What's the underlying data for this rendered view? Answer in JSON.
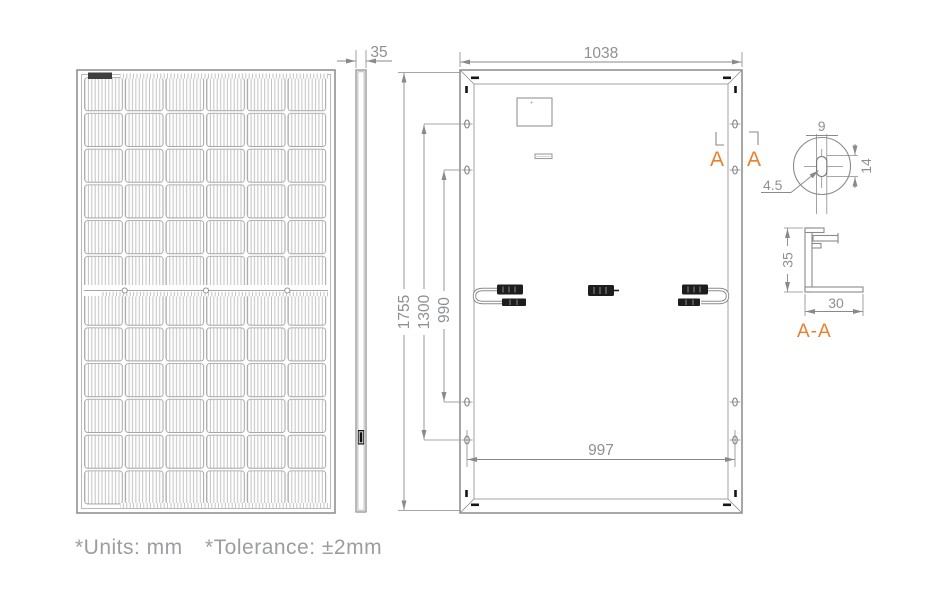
{
  "colors": {
    "line": "#8a8a8a",
    "dark": "#1d1d1d",
    "dim_text": "#8d9194",
    "accent": "#E9802C",
    "note_text": "#9a9ea1"
  },
  "dims": {
    "side_thickness": "35",
    "back_width": "1038",
    "total_height": "1755",
    "mount_span_outer": "1300",
    "mount_span_inner": "990",
    "mount_span_width": "997"
  },
  "hole_detail": {
    "slot_width": "9",
    "slot_radius": "4.5",
    "slot_height": "14"
  },
  "frame_section": {
    "height": "35",
    "depth": "30"
  },
  "section": {
    "marker_left": "A",
    "marker_right": "A",
    "title": "A-A"
  },
  "notes": {
    "units": "*Units: mm",
    "tolerance": "*Tolerance: ±2mm"
  }
}
